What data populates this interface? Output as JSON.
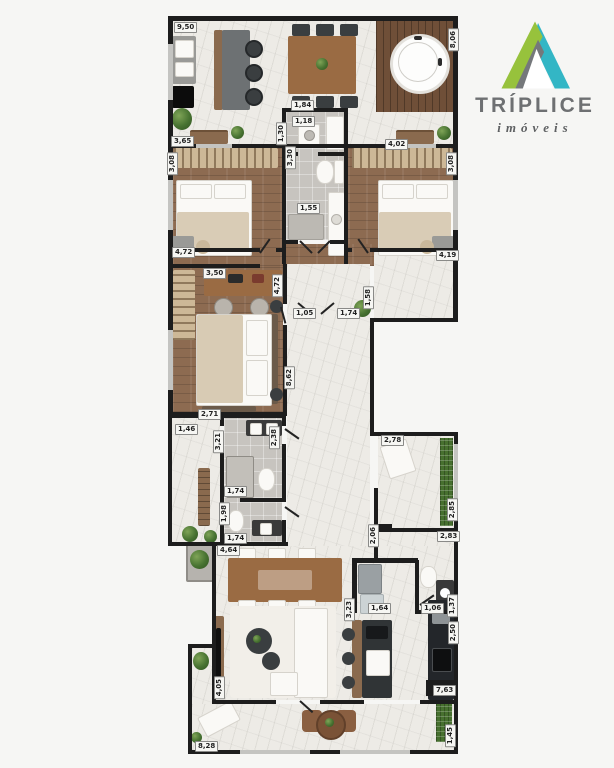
{
  "brand": {
    "name": "TRÍPLICE",
    "tagline": "imóveis",
    "logo_colors": {
      "green": "#97c23c",
      "teal": "#33b6c5",
      "gray": "#75787b",
      "text": "#6e7072"
    }
  },
  "plan": {
    "wall_color": "#1d1d1d",
    "dimension_labels": [
      {
        "value": "9,50",
        "x": 174,
        "y": 22,
        "vertical": false
      },
      {
        "value": "8,06",
        "x": 448,
        "y": 28,
        "vertical": true
      },
      {
        "value": "3,65",
        "x": 171,
        "y": 136,
        "vertical": false
      },
      {
        "value": "1,84",
        "x": 291,
        "y": 100,
        "vertical": false
      },
      {
        "value": "1,18",
        "x": 292,
        "y": 116,
        "vertical": false
      },
      {
        "value": "1,30",
        "x": 276,
        "y": 122,
        "vertical": true
      },
      {
        "value": "4,02",
        "x": 385,
        "y": 139,
        "vertical": false
      },
      {
        "value": "3,30",
        "x": 285,
        "y": 146,
        "vertical": true
      },
      {
        "value": "3,08",
        "x": 167,
        "y": 152,
        "vertical": true
      },
      {
        "value": "3,08",
        "x": 446,
        "y": 152,
        "vertical": true
      },
      {
        "value": "1,55",
        "x": 297,
        "y": 203,
        "vertical": false
      },
      {
        "value": "4,72",
        "x": 172,
        "y": 247,
        "vertical": false
      },
      {
        "value": "4,19",
        "x": 436,
        "y": 250,
        "vertical": false
      },
      {
        "value": "3,50",
        "x": 203,
        "y": 268,
        "vertical": false
      },
      {
        "value": "4,72",
        "x": 272,
        "y": 274,
        "vertical": true
      },
      {
        "value": "2,71",
        "x": 198,
        "y": 409,
        "vertical": false
      },
      {
        "value": "1,05",
        "x": 293,
        "y": 308,
        "vertical": false
      },
      {
        "value": "1,74",
        "x": 337,
        "y": 308,
        "vertical": false
      },
      {
        "value": "1,58",
        "x": 363,
        "y": 286,
        "vertical": true
      },
      {
        "value": "8,62",
        "x": 284,
        "y": 366,
        "vertical": true
      },
      {
        "value": "1,46",
        "x": 175,
        "y": 424,
        "vertical": false
      },
      {
        "value": "3,21",
        "x": 213,
        "y": 430,
        "vertical": true
      },
      {
        "value": "2,38",
        "x": 269,
        "y": 426,
        "vertical": true
      },
      {
        "value": "1,74",
        "x": 224,
        "y": 486,
        "vertical": false
      },
      {
        "value": "1,98",
        "x": 219,
        "y": 502,
        "vertical": true
      },
      {
        "value": "1,74",
        "x": 224,
        "y": 533,
        "vertical": false
      },
      {
        "value": "4,64",
        "x": 217,
        "y": 545,
        "vertical": false
      },
      {
        "value": "2,78",
        "x": 381,
        "y": 435,
        "vertical": false
      },
      {
        "value": "2,85",
        "x": 447,
        "y": 498,
        "vertical": true
      },
      {
        "value": "2,06",
        "x": 368,
        "y": 524,
        "vertical": true
      },
      {
        "value": "2,83",
        "x": 437,
        "y": 531,
        "vertical": false
      },
      {
        "value": "1,06",
        "x": 421,
        "y": 603,
        "vertical": false
      },
      {
        "value": "1,37",
        "x": 447,
        "y": 594,
        "vertical": true
      },
      {
        "value": "2,50",
        "x": 448,
        "y": 621,
        "vertical": true
      },
      {
        "value": "3,23",
        "x": 344,
        "y": 598,
        "vertical": true
      },
      {
        "value": "1,64",
        "x": 368,
        "y": 603,
        "vertical": false
      },
      {
        "value": "7,63",
        "x": 433,
        "y": 685,
        "vertical": false
      },
      {
        "value": "4,05",
        "x": 214,
        "y": 676,
        "vertical": true
      },
      {
        "value": "8,28",
        "x": 195,
        "y": 741,
        "vertical": false
      },
      {
        "value": "1,45",
        "x": 445,
        "y": 724,
        "vertical": true
      }
    ]
  }
}
